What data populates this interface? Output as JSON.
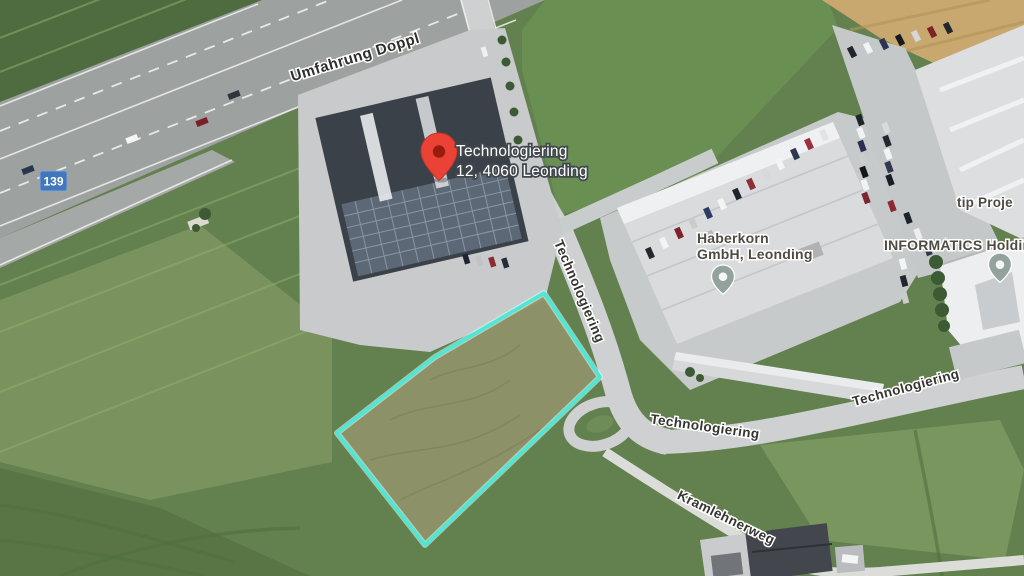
{
  "map": {
    "route_badge": "139",
    "highway_label": "Umfahrung Doppl",
    "marker": {
      "line1": "Technologiering",
      "line2": "12, 4060 Leonding"
    },
    "roads": {
      "tech_vertical": "Technologiering",
      "tech_curve": "Technologiering",
      "tech_east": "Technologiering",
      "kramlehnerweg": "Kramlehnerweg"
    },
    "pois": {
      "haberkorn_line1": "Haberkorn",
      "haberkorn_line2": "GmbH, Leonding",
      "informatics": "INFORMATICS Holding",
      "tip": "tip Proje"
    },
    "parcel_outline_points": "544,293 600,377 425,545 337,433 435,357",
    "colors": {
      "parcel_outline": "#4be8d8",
      "marker_red": "#ea4335",
      "marker_red_dark": "#991b10",
      "badge_blue": "#4377bb",
      "poi_pin_gray": "#93a29c",
      "field_green": "#63804f",
      "highway_gray": "#9da1a0",
      "road_gray": "#ced0d1"
    }
  }
}
